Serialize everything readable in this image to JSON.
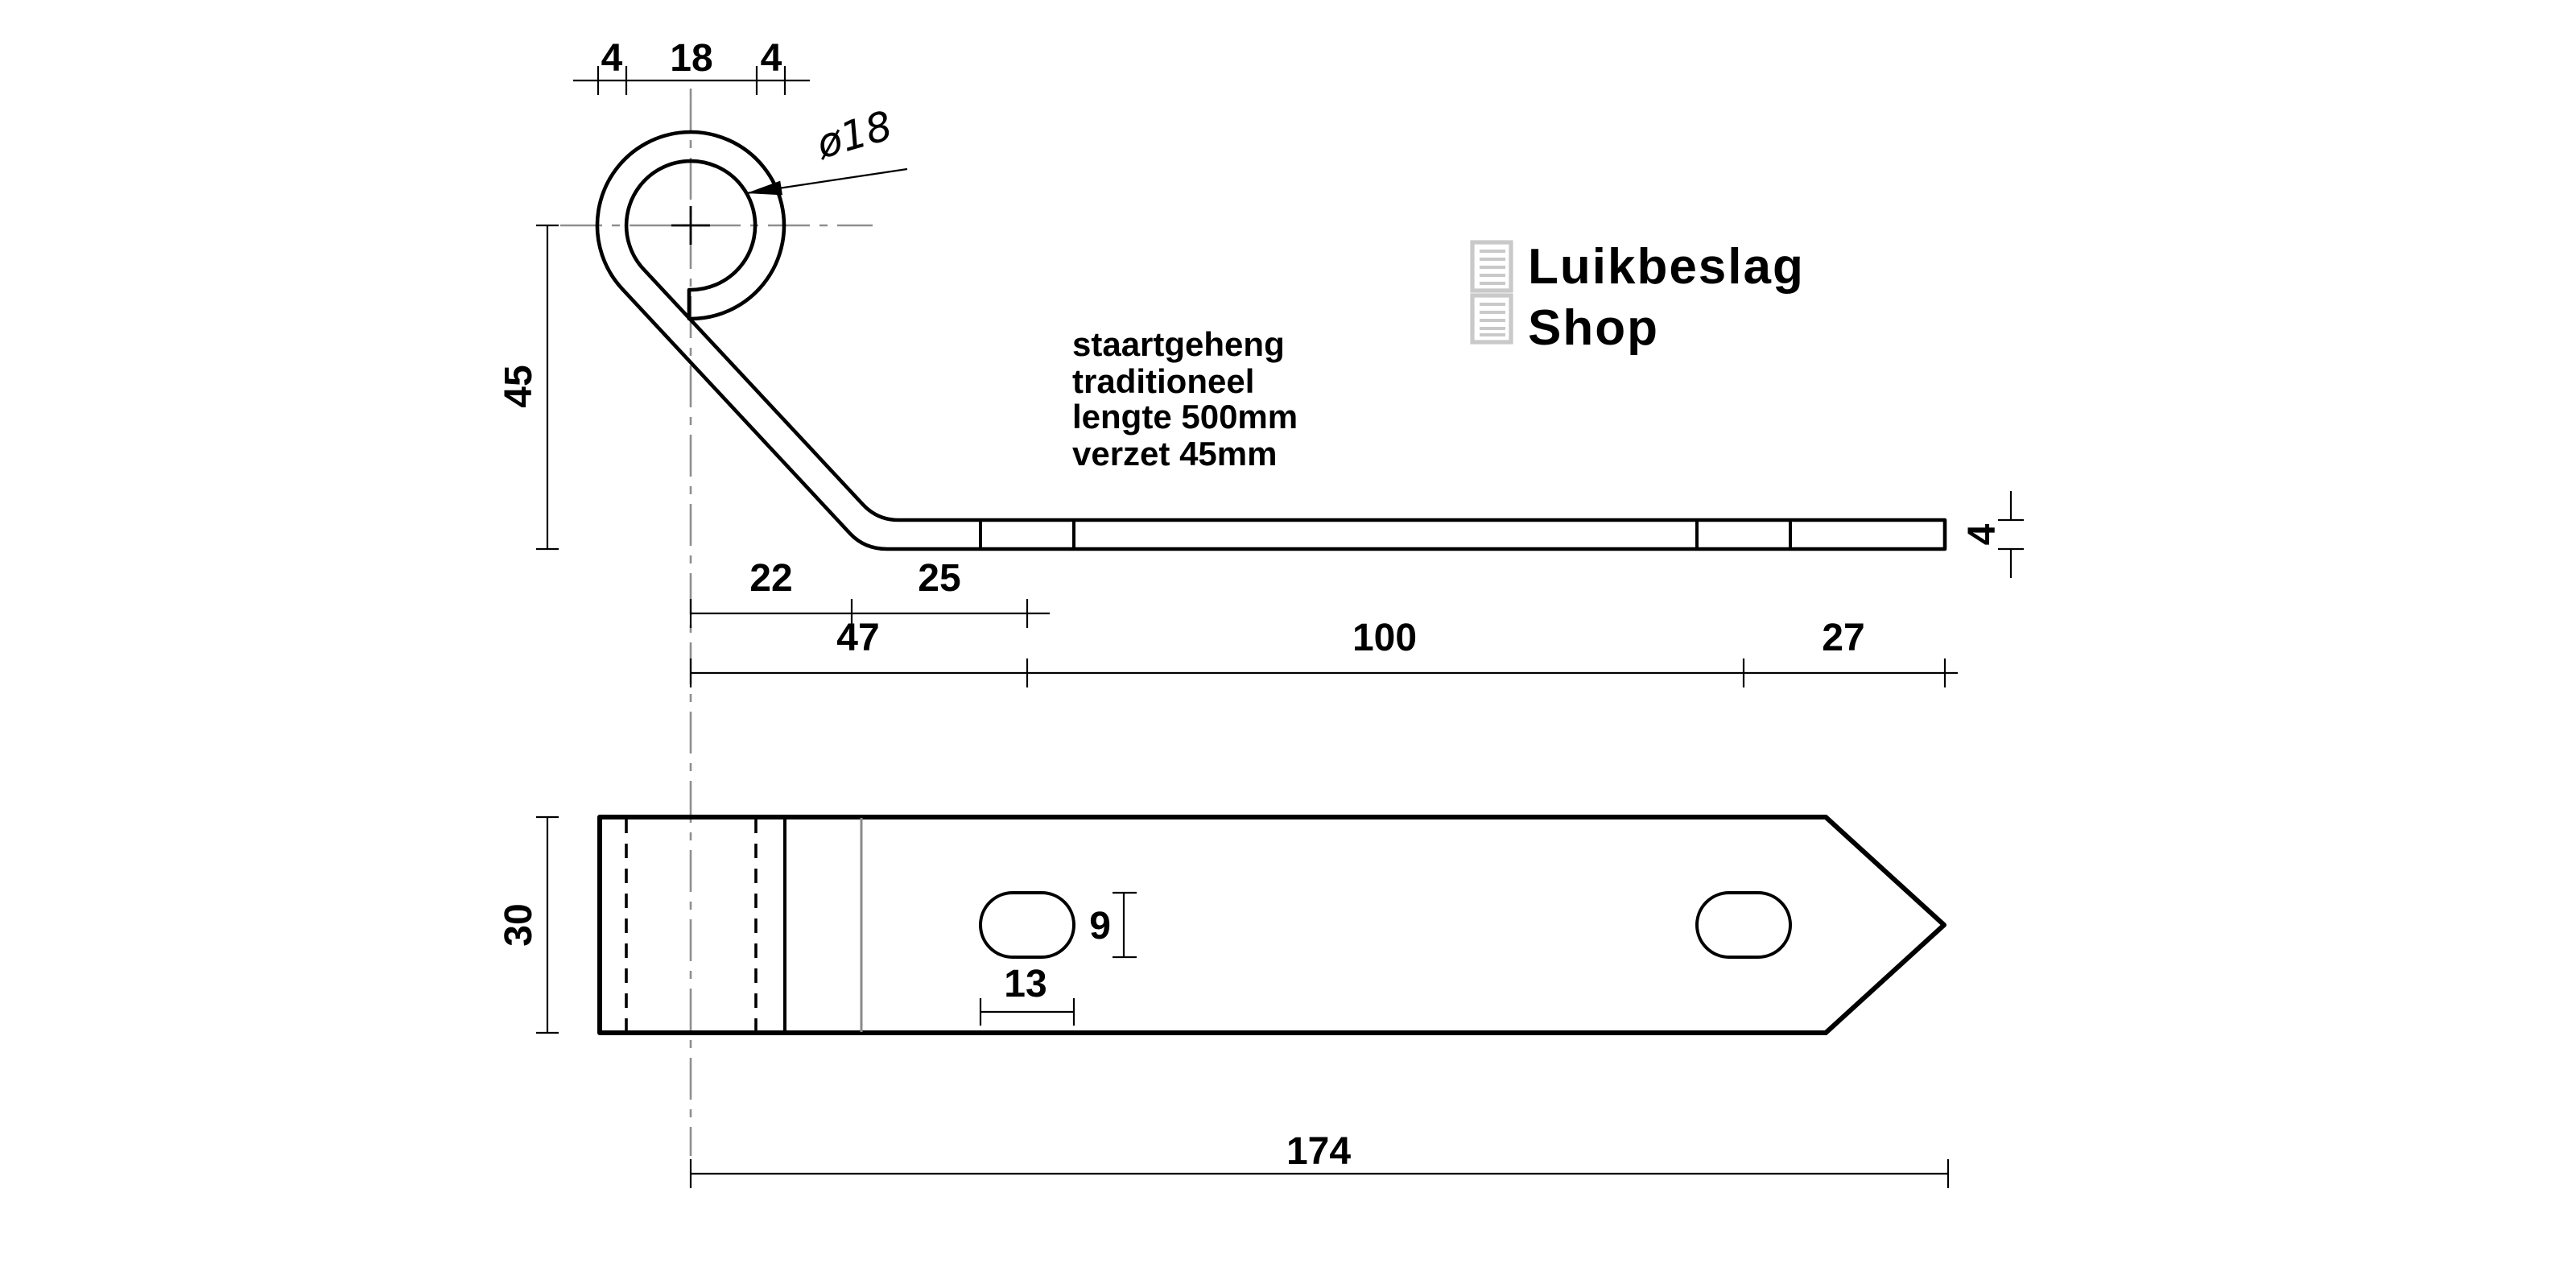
{
  "logo": {
    "line1": "Luikbeslag",
    "line2": "Shop"
  },
  "note": {
    "lines": [
      "staartgeheng",
      "traditioneel",
      "lengte 500mm",
      "verzet 45mm"
    ]
  },
  "dimensions": {
    "eye_wall_left": "4",
    "eye_inner_diameter": "18",
    "eye_wall_right": "4",
    "eye_diameter_label": "ø18",
    "offset_height": "45",
    "bend_offset": "22",
    "bend_to_hole": "25",
    "hole1_from_center": "47",
    "hole_spacing": "100",
    "hole2_to_tip": "27",
    "strap_thickness": "4",
    "strap_width": "30",
    "slot_height": "9",
    "slot_length": "13",
    "total_length": "174"
  },
  "colors": {
    "line": "#000000",
    "centerline": "#8f8f8f",
    "logo_gray": "#c9c9c9"
  }
}
